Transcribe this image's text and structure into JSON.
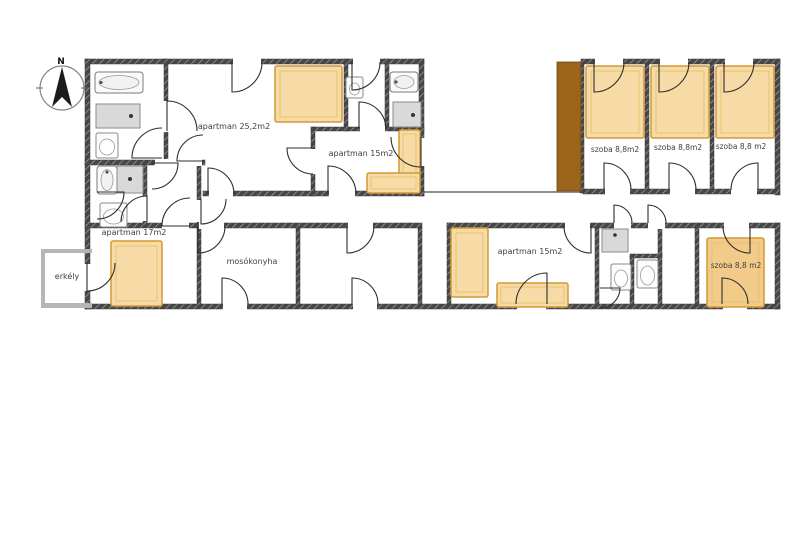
{
  "plan": {
    "compass": {
      "label": "N",
      "cx": 62,
      "cy": 88,
      "r": 22
    },
    "colors": {
      "wall_dark": "#474747",
      "wall_hatch_light": "#a6a6a6",
      "wall_light": "#b5b5b5",
      "edge_line": "#8e8e8e",
      "wardrobe_brown": "#9a651b",
      "bed_fill": "#f7dba6",
      "bed_border": "#d49a31",
      "bed_inner_border": "#e8c070",
      "bed_fill_deep": "#f2cb8a",
      "fixture_stroke": "#7a7a7a",
      "shower_fill": "#d9d9d9",
      "door": "#2e2e2e",
      "text": "#3f3f3f"
    },
    "labels": [
      {
        "id": "apartman-25-2",
        "text": "apartman 25,2m2",
        "x": 234,
        "y": 129,
        "size": 8
      },
      {
        "id": "apartman-15-top",
        "text": "apartman 15m2",
        "x": 361,
        "y": 156,
        "size": 8
      },
      {
        "id": "szoba-1",
        "text": "szoba 8,8m2",
        "x": 615,
        "y": 152,
        "size": 7.5
      },
      {
        "id": "szoba-2",
        "text": "szoba 8,8m2",
        "x": 678,
        "y": 150,
        "size": 7.5
      },
      {
        "id": "szoba-3",
        "text": "szoba 8,8 m2",
        "x": 741,
        "y": 149,
        "size": 7.5
      },
      {
        "id": "apartman-17",
        "text": "apartman 17m2",
        "x": 134,
        "y": 235,
        "size": 8
      },
      {
        "id": "erkely",
        "text": "erkély",
        "x": 67,
        "y": 279,
        "size": 8
      },
      {
        "id": "mosokonyha",
        "text": "mosókonyha",
        "x": 252,
        "y": 264,
        "size": 8
      },
      {
        "id": "apartman-15-bottom",
        "text": "apartman 15m2",
        "x": 530,
        "y": 254,
        "size": 8
      },
      {
        "id": "szoba-4",
        "text": "szoba 8,8 m2",
        "x": 736,
        "y": 268,
        "size": 7.5
      }
    ],
    "walls": [
      [
        85,
        59,
        339,
        5,
        "t"
      ],
      [
        581,
        59,
        199,
        5,
        "t"
      ],
      [
        85,
        160,
        120,
        5,
        "t"
      ],
      [
        203,
        191,
        221,
        5,
        "t"
      ],
      [
        583,
        189,
        197,
        5,
        "t"
      ],
      [
        85,
        223,
        337,
        5,
        "t"
      ],
      [
        447,
        223,
        333,
        5,
        "t"
      ],
      [
        85,
        304,
        695,
        5,
        "t"
      ],
      [
        311,
        127,
        113,
        4,
        "t"
      ],
      [
        630,
        254,
        32,
        4,
        "t"
      ],
      [
        424,
        191,
        159,
        2,
        "e"
      ],
      [
        85,
        59,
        5,
        250,
        "t"
      ],
      [
        164,
        59,
        4,
        105,
        "t"
      ],
      [
        311,
        127,
        4,
        69,
        "t"
      ],
      [
        344,
        59,
        4,
        72,
        "t"
      ],
      [
        385,
        59,
        4,
        70,
        "t"
      ],
      [
        419,
        59,
        5,
        137,
        "t"
      ],
      [
        580,
        62,
        4,
        131,
        "t"
      ],
      [
        645,
        63,
        4,
        128,
        "t"
      ],
      [
        710,
        63,
        4,
        128,
        "t"
      ],
      [
        775,
        59,
        5,
        136,
        "t"
      ],
      [
        775,
        223,
        5,
        86,
        "t"
      ],
      [
        143,
        162,
        4,
        65,
        "t"
      ],
      [
        197,
        160,
        4,
        147,
        "t"
      ],
      [
        296,
        227,
        4,
        79,
        "t"
      ],
      [
        418,
        227,
        4,
        79,
        "t"
      ],
      [
        447,
        223,
        4,
        83,
        "t"
      ],
      [
        595,
        227,
        4,
        79,
        "t"
      ],
      [
        630,
        256,
        4,
        50,
        "t"
      ],
      [
        658,
        223,
        4,
        83,
        "t"
      ],
      [
        695,
        223,
        4,
        83,
        "t"
      ],
      [
        41,
        249,
        51,
        4,
        "l"
      ],
      [
        41,
        249,
        4,
        59,
        "l"
      ],
      [
        41,
        303,
        51,
        5,
        "l"
      ]
    ],
    "wardrobe": [
      557,
      62,
      24,
      129
    ],
    "door_gaps": [
      [
        163,
        101,
        7,
        31
      ],
      [
        233,
        58,
        28,
        7
      ],
      [
        353,
        58,
        27,
        7
      ],
      [
        360,
        126,
        25,
        6
      ],
      [
        310,
        149,
        6,
        25
      ],
      [
        329,
        190,
        26,
        7
      ],
      [
        418,
        138,
        7,
        28
      ],
      [
        155,
        159,
        47,
        7
      ],
      [
        209,
        190,
        24,
        7
      ],
      [
        196,
        200,
        7,
        22
      ],
      [
        142,
        196,
        6,
        25
      ],
      [
        162,
        222,
        27,
        7
      ],
      [
        84,
        264,
        7,
        27
      ],
      [
        348,
        222,
        25,
        7
      ],
      [
        353,
        303,
        24,
        7
      ],
      [
        223,
        303,
        24,
        7
      ],
      [
        199,
        222,
        25,
        7
      ],
      [
        565,
        222,
        25,
        7
      ],
      [
        517,
        303,
        29,
        7
      ],
      [
        614,
        222,
        17,
        7
      ],
      [
        648,
        222,
        17,
        7
      ],
      [
        724,
        222,
        25,
        7
      ],
      [
        723,
        303,
        24,
        7
      ],
      [
        595,
        58,
        28,
        7
      ],
      [
        660,
        58,
        28,
        7
      ],
      [
        725,
        58,
        28,
        7
      ],
      [
        605,
        188,
        25,
        7
      ],
      [
        670,
        188,
        25,
        7
      ],
      [
        731,
        188,
        26,
        7
      ]
    ],
    "doors": [
      [
        167,
        131,
        30,
        270,
        360,
        1
      ],
      [
        162,
        158,
        30,
        180,
        270,
        1
      ],
      [
        232,
        62,
        30,
        90,
        0,
        0
      ],
      [
        352,
        62,
        28,
        90,
        0,
        0
      ],
      [
        359,
        129,
        27,
        270,
        360,
        1
      ],
      [
        313,
        148,
        26,
        180,
        90,
        0
      ],
      [
        328,
        194,
        28,
        270,
        360,
        1
      ],
      [
        421,
        137,
        30,
        90,
        180,
        1
      ],
      [
        203,
        161,
        26,
        180,
        270,
        1
      ],
      [
        152,
        163,
        26,
        0,
        90,
        1
      ],
      [
        208,
        194,
        26,
        270,
        360,
        1
      ],
      [
        201,
        199,
        25,
        90,
        0,
        0
      ],
      [
        97,
        192,
        27,
        0,
        90,
        1
      ],
      [
        147,
        222,
        26,
        270,
        180,
        0
      ],
      [
        190,
        226,
        28,
        180,
        270,
        1
      ],
      [
        87,
        263,
        28,
        90,
        0,
        0
      ],
      [
        347,
        226,
        27,
        90,
        0,
        0
      ],
      [
        352,
        304,
        26,
        270,
        360,
        1
      ],
      [
        222,
        304,
        26,
        270,
        360,
        1
      ],
      [
        198,
        226,
        27,
        90,
        0,
        0
      ],
      [
        591,
        226,
        27,
        90,
        180,
        1
      ],
      [
        547,
        304,
        31,
        270,
        180,
        0
      ],
      [
        600,
        288,
        20,
        0,
        90,
        1
      ],
      [
        614,
        223,
        18,
        270,
        360,
        1
      ],
      [
        648,
        223,
        18,
        270,
        360,
        1
      ],
      [
        750,
        226,
        27,
        90,
        180,
        1
      ],
      [
        722,
        304,
        26,
        270,
        360,
        1
      ],
      [
        594,
        62,
        30,
        90,
        0,
        0
      ],
      [
        659,
        62,
        30,
        90,
        0,
        0
      ],
      [
        724,
        62,
        30,
        90,
        0,
        0
      ],
      [
        604,
        190,
        27,
        270,
        360,
        1
      ],
      [
        669,
        190,
        27,
        270,
        360,
        1
      ],
      [
        758,
        190,
        27,
        270,
        180,
        0
      ]
    ],
    "beds": [
      [
        275,
        66,
        67,
        56,
        0
      ],
      [
        586,
        66,
        58,
        72,
        0
      ],
      [
        651,
        66,
        58,
        72,
        0
      ],
      [
        716,
        66,
        58,
        72,
        0
      ],
      [
        111,
        241,
        51,
        65,
        0
      ],
      [
        451,
        228,
        37,
        69,
        0
      ],
      [
        707,
        238,
        57,
        69,
        1
      ]
    ],
    "sofas": [
      [
        399,
        130,
        21,
        47
      ],
      [
        367,
        173,
        53,
        20
      ],
      [
        497,
        283,
        71,
        24
      ]
    ],
    "bathtubs": [
      [
        95,
        72,
        48,
        21
      ],
      [
        390,
        72,
        28,
        20
      ],
      [
        97,
        166,
        20,
        28
      ]
    ],
    "showers": [
      [
        96,
        104,
        44,
        24,
        35,
        12
      ],
      [
        393,
        102,
        28,
        25,
        20,
        13
      ],
      [
        117,
        166,
        26,
        27,
        13,
        13
      ]
    ],
    "sinks": [
      [
        602,
        229,
        26,
        23,
        13,
        6
      ]
    ],
    "toilets": [
      [
        96,
        133,
        22,
        25
      ],
      [
        346,
        77,
        17,
        21
      ],
      [
        100,
        203,
        27,
        24
      ],
      [
        611,
        264,
        20,
        26
      ],
      [
        637,
        260,
        21,
        28
      ]
    ]
  }
}
